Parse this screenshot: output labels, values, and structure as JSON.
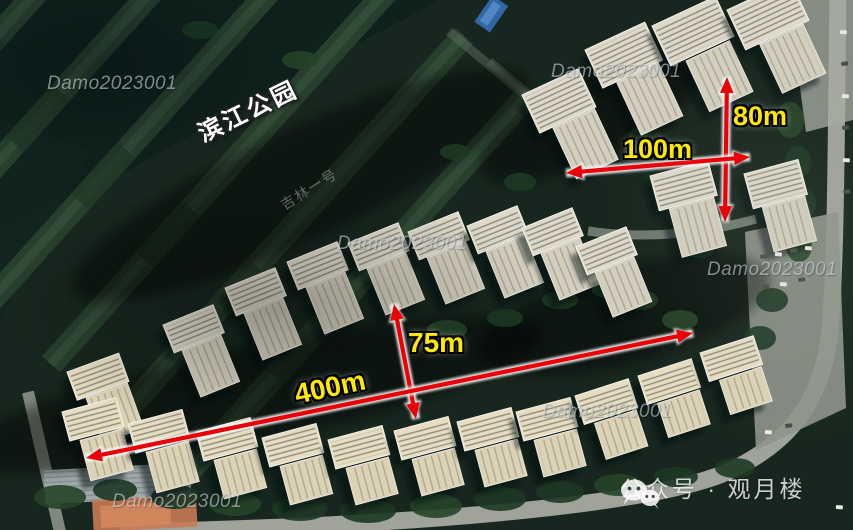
{
  "scene": {
    "kind": "annotated satellite aerial photo of riverside residential compound",
    "park_label": "滨江公园",
    "imagery_watermark": "吉林一号"
  },
  "measurements": [
    {
      "name": "building-depth-vertical",
      "label": "80m"
    },
    {
      "name": "building-gap-horizontal",
      "label": "100m"
    },
    {
      "name": "row-spacing-vertical",
      "label": "75m"
    },
    {
      "name": "row-length-diagonal",
      "label": "400m"
    }
  ],
  "watermark": {
    "text": "Damo2023001",
    "count": 6
  },
  "credit": {
    "icon": "wechat-icon",
    "label": "公众号 · 观月楼"
  },
  "colors": {
    "arrow_red": "#ea0006",
    "label_yellow": "#ffe900",
    "watermark_gray": "#c3ced4",
    "park_label_white": "#ffffff"
  }
}
